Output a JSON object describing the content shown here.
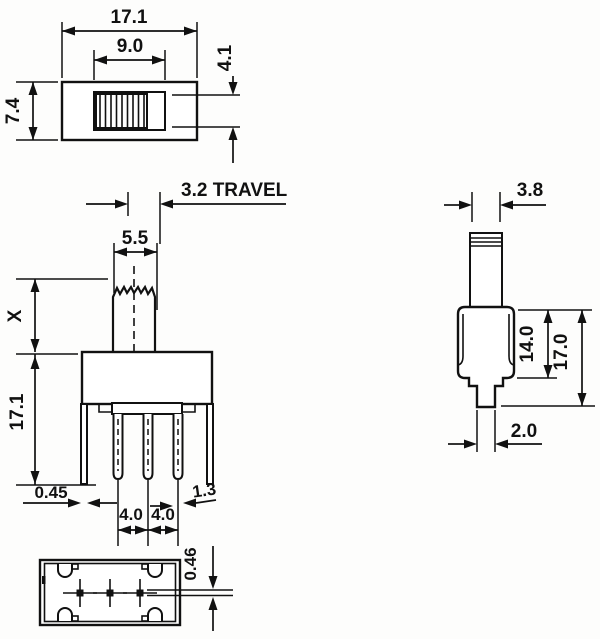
{
  "drawing": {
    "type": "technical-dimension-drawing",
    "subject": "slide switch",
    "ink_color": "#111111",
    "paper_color": "#fdfdfc"
  },
  "views": {
    "top": {
      "overall_width": "17.1",
      "slot_width": "9.0",
      "body_depth": "7.4",
      "knob_depth": "4.1"
    },
    "front": {
      "travel": "3.2  TRAVEL",
      "knob_width": "5.5",
      "knob_height": "X",
      "body_height": "17.1",
      "bracket_thickness": "0.45",
      "pin_pitch_left": "4.0",
      "pin_pitch_right": "4.0",
      "terminal_width": "1.3"
    },
    "side": {
      "knob_thickness": "3.8",
      "body_height": "14.0",
      "overall_height": "17.0",
      "terminal_width": "2.0"
    },
    "bottom": {
      "terminal_thickness": "0.46"
    }
  }
}
